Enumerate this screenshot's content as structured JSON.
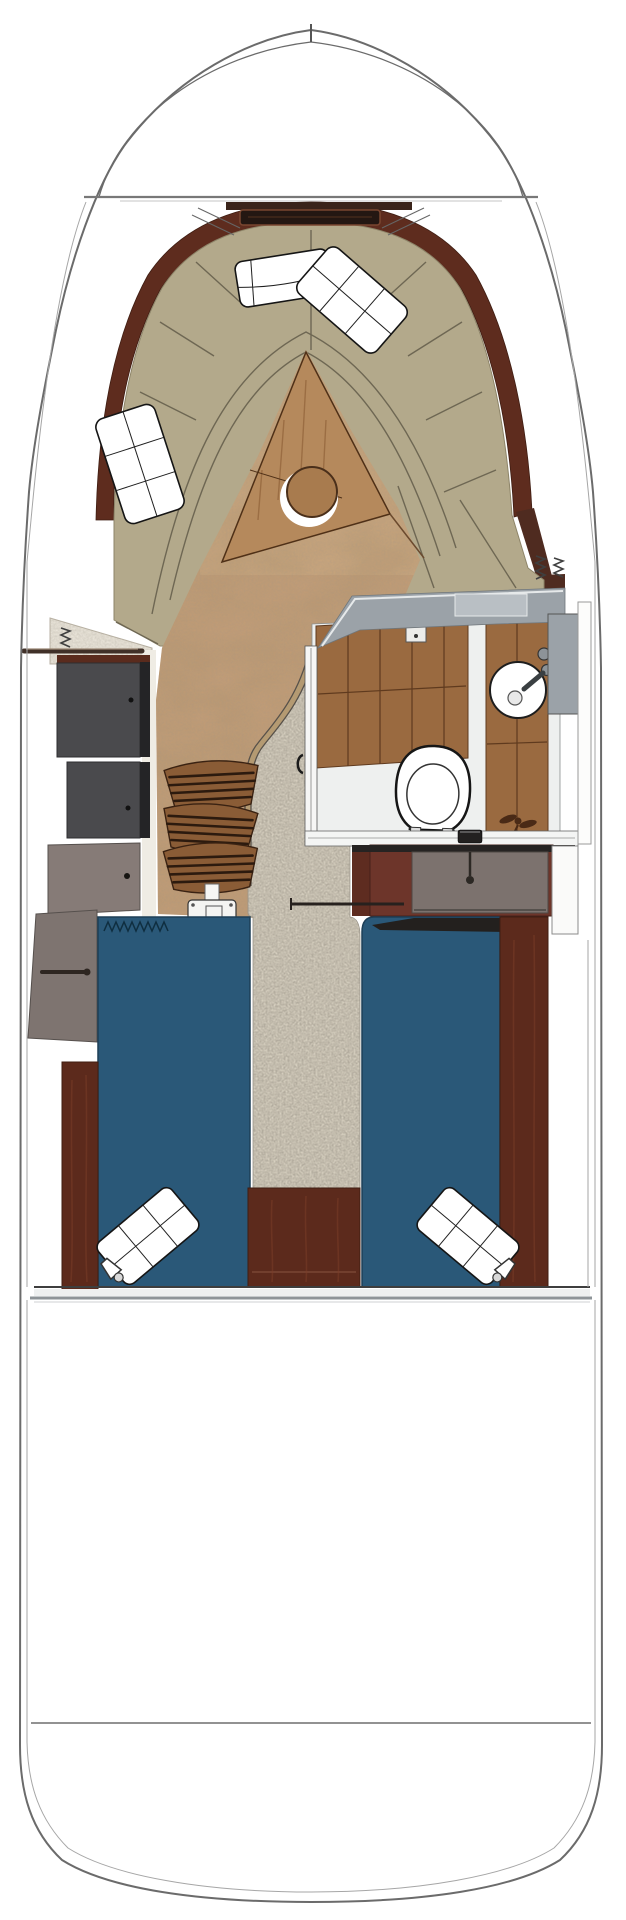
{
  "figure": {
    "kind": "boat-deck-floorplan",
    "view": "top-down"
  },
  "colors": {
    "background": "#ffffff",
    "hull_line": "#6b6b6b",
    "liner_line": "#a6a6a6",
    "mahogany": "#5e2c1e",
    "mahogany_dark": "#4f2b20",
    "mahogany_light": "#7c3d28",
    "hatch_dark": "#241712",
    "cushion_tan": "#b3a98b",
    "cushion_seam": "#6e6753",
    "wood_insert": "#b5895c",
    "table_wood": "#a87b4e",
    "floor_wood": "#c49e78",
    "carpet": "#d7d0c0",
    "carpet_trim": "#b49a72",
    "teak": "#9a6a40",
    "teak_line": "#5f3a1e",
    "head_floor": "#eef0ef",
    "counter_gray": "#9ba2a8",
    "counter_light": "#b9bfc4",
    "cabinet_dark": "#4a4a4d",
    "cabinet_taupe": "#867b77",
    "cabinet_taupe2": "#7e7470",
    "dresser_maroon": "#6d352a",
    "drawer_taupe": "#7c726e",
    "berth_blue": "#2a5878",
    "berth_blue_dark": "#1d3f57",
    "board_mahogany": "#5c2a1c",
    "step_wood": "#8a5c36",
    "step_slat": "#2c1a0e",
    "chrome": "#8e9498",
    "strip_dark": "#262322"
  },
  "counts": {
    "companionway_steps": 3,
    "berths": 2,
    "throw_pillows": 5,
    "reading_lights": 2
  },
  "features": [
    "bow-pulpit-rail",
    "deck-line",
    "bow-hatch",
    "v-berth-lounge",
    "mahogany-trim",
    "throw-pillows",
    "v-berth-table",
    "cabin-sole",
    "carpet-runner",
    "companionway-steps",
    "galley-cabinets",
    "storage-lockers",
    "grab-rail",
    "head-compartment",
    "vanity-counter",
    "sink",
    "toilet",
    "teak-shower-floor",
    "port-berth",
    "starboard-berth",
    "berth-divider",
    "dresser-drawer",
    "reading-lights",
    "aft-bulkhead",
    "transom-line",
    "hull-outline"
  ]
}
